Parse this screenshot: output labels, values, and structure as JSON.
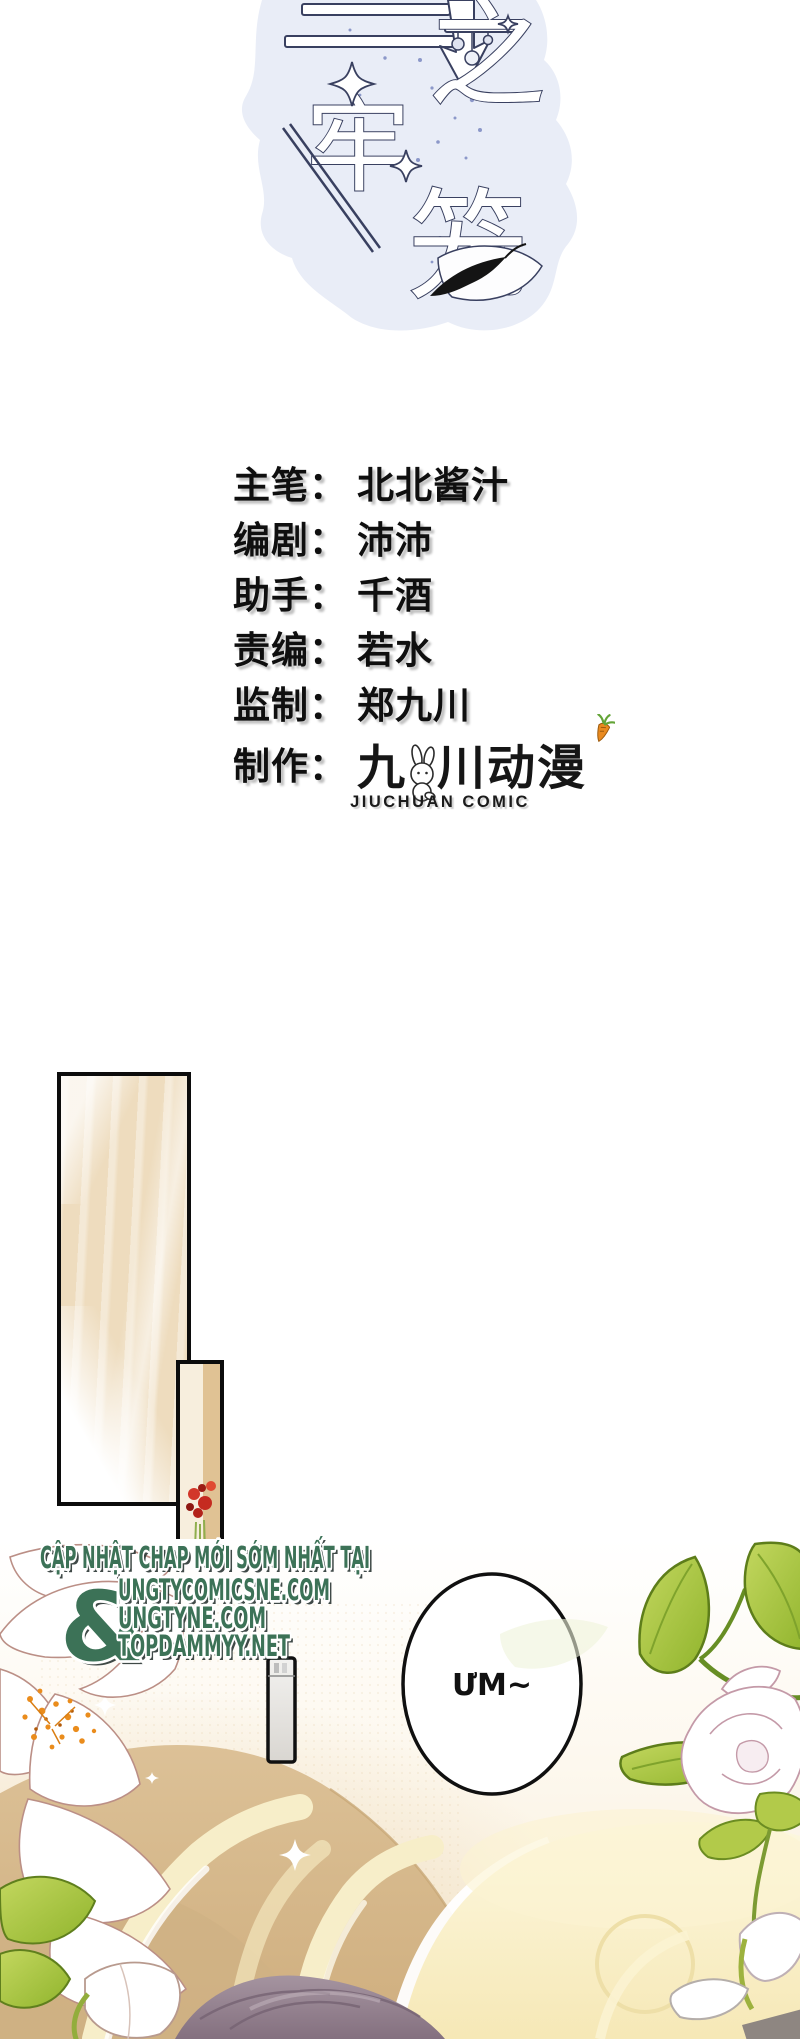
{
  "page": {
    "width": 800,
    "height": 2039,
    "background": "#ffffff"
  },
  "title_art": {
    "characters": {
      "char1": "之",
      "char2": "牢",
      "char3": "笼"
    },
    "blob_color": "#e9edf7",
    "outline_color": "#394060",
    "speckle_color": "#6d7cba"
  },
  "credits": {
    "colon": "：",
    "rows": [
      {
        "label": "主笔",
        "value": "北北酱汁"
      },
      {
        "label": "编剧",
        "value": "沛沛"
      },
      {
        "label": "助手",
        "value": "千酒"
      },
      {
        "label": "责编",
        "value": "若水"
      },
      {
        "label": "监制",
        "value": "郑九川"
      },
      {
        "label": "制作",
        "value": ""
      }
    ]
  },
  "studio_logo": {
    "cjk_left": "九",
    "cjk_mid": "川",
    "cjk_right": "动漫",
    "latin": "JIUCHUAN COMIC",
    "mascot_icons": [
      "rabbit-icon",
      "carrot-icon"
    ],
    "carrot_color": "#e98a1f",
    "carrot_leaf_color": "#63a437"
  },
  "speech_bubble": {
    "text": "ƯM~"
  },
  "watermark": {
    "heading": "CẬP NHẬT CHAP MỚI SỚM NHẤT TẠI",
    "ampersand": "&",
    "sites": [
      "UNGTYCOMICSNE.COM",
      "UNGTYNE.COM",
      "TOPDAMMYY.NET"
    ],
    "text_color": "#3c7257",
    "outline_color": "#ffffff",
    "shadow_color": "#2b3634"
  },
  "artwork_colors": {
    "panel_beige": "#f1e2c8",
    "sofa_tan": "#d8bb90",
    "stripe_cream": "#f7eec9",
    "pillow_yellow": "#fbf2cf",
    "hair_mauve": "#a594a0",
    "leaf_green": "#90b42c",
    "flower_red": "#c52b20"
  }
}
